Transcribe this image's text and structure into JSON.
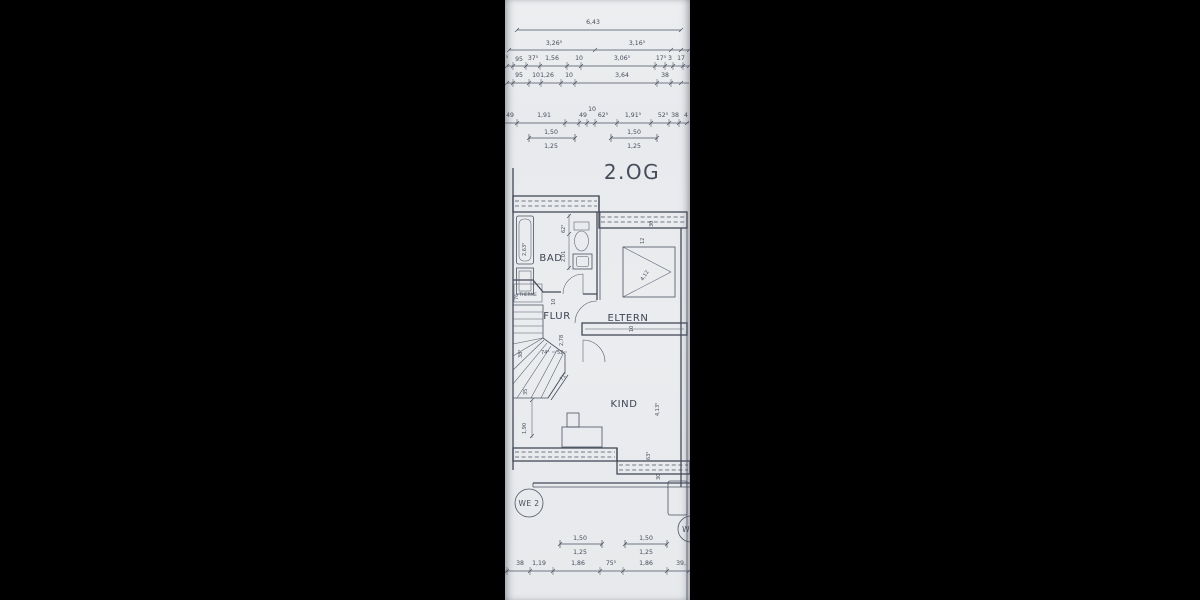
{
  "colors": {
    "paper": "#e9ebee",
    "ink": "#4a5160",
    "accent_red": "#d4686a",
    "side_bars": "#000000"
  },
  "floor_label": "2.OG",
  "rooms": {
    "bad": "BAD",
    "flur": "FLUR",
    "eltern": "ELTERN",
    "kind": "KIND",
    "therme": "THERME"
  },
  "unit_badges": {
    "we2": "WE 2",
    "we_next": "W"
  },
  "top_chains": {
    "total": "6,43",
    "row2": [
      "3,26⁵",
      "3,16⁵"
    ],
    "row3_prefix": "⁵",
    "row3": [
      "95",
      "37⁵",
      "1,56",
      "10",
      "3,06⁵",
      "17⁵",
      "3",
      "17"
    ],
    "row4": [
      "95",
      "10",
      "1,26",
      "10",
      "3,64",
      "38"
    ],
    "row5": [
      "49",
      "1,91",
      "49",
      "10",
      "62⁵",
      "1,91⁵",
      "52⁵",
      "38",
      "4"
    ]
  },
  "window_dim": {
    "outer": "1,50",
    "inner": "1,25"
  },
  "bottom_chain": [
    "38",
    "1,19",
    "1,86",
    "75⁵",
    "1,86",
    "39,"
  ],
  "plan_dims": {
    "tub_length": "2,63⁵",
    "bad_width_a": "2,01",
    "bad_width_b": "62⁵",
    "therme_76": "76",
    "flur_10": "10",
    "eltern_30": "30",
    "eltern_12": "12",
    "wardrobe_diag": "4,12",
    "eltern_wall_10": "10",
    "flur_height": "2,78",
    "flur_w_a": "74⁵",
    "flur_w_b": "52",
    "stair_38": "38⁵",
    "stair_35": "35",
    "stair_71": "71⁵",
    "left_height": "1,90",
    "kind_height": "4,13⁵",
    "kind_63": "63⁵",
    "kind_30": "30"
  }
}
